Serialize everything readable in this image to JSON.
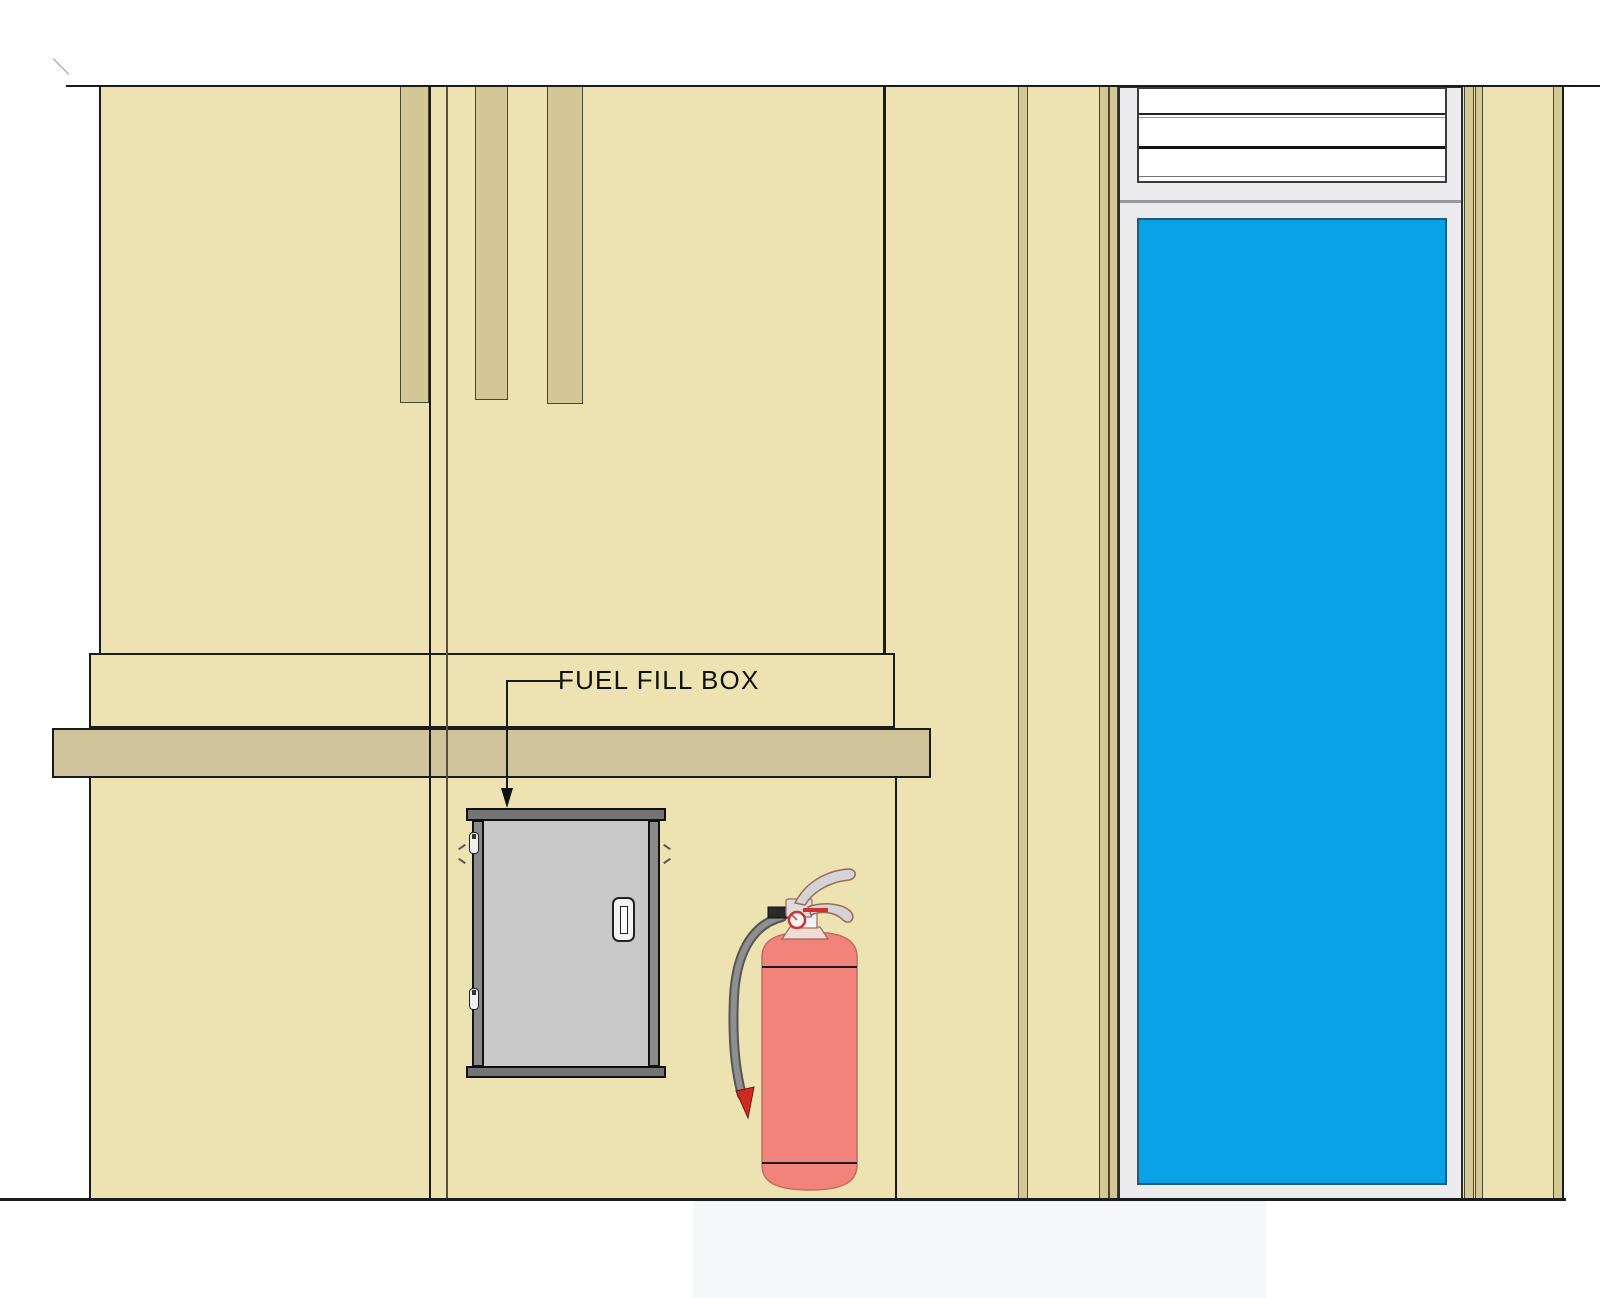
{
  "drawing": {
    "annotation": {
      "label": "FUEL FILL BOX"
    },
    "colors": {
      "wall": "#EDE3B2",
      "trim_strip": "#D3C795",
      "ledge_band": "#CFC49B",
      "outline": "#1B1B1B",
      "joint_olive": "#57513C",
      "glass": "#09A1E8",
      "glass_edge": "#1E5C7D",
      "door_frame": "#ECECEE",
      "frame_divider": "#97999C",
      "louver_white": "#FFFFFF",
      "cabinet_cap": "#747474",
      "cabinet_frame": "#8A8A8A",
      "cabinet_door": "#C9C9C9",
      "extinguisher_body": "#F2837B",
      "extinguisher_metal": "#DCDCDC",
      "extinguisher_hose": "#8F8F8F",
      "nozzle_red": "#CC2A22",
      "paving": "#F5F6F8"
    }
  }
}
